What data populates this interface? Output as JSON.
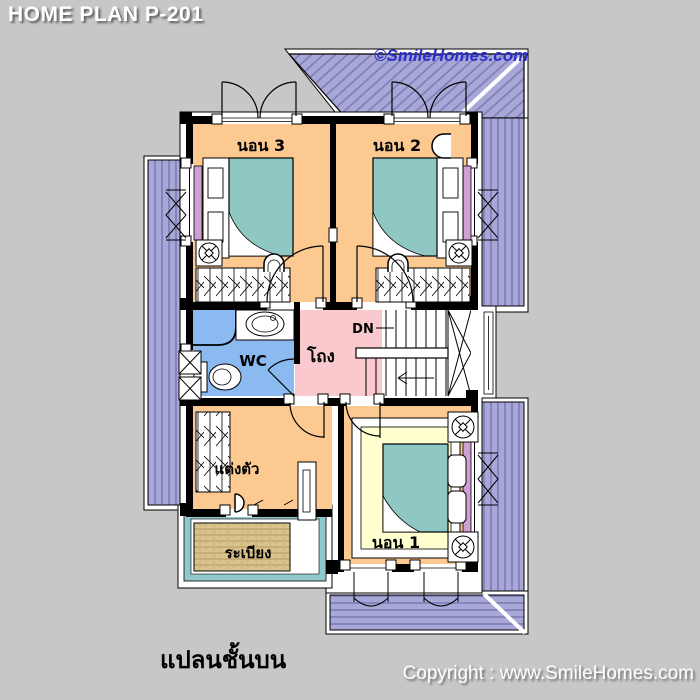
{
  "header": {
    "title": "HOME PLAN P-201"
  },
  "watermark": {
    "text": "©SmileHomes.com"
  },
  "plan": {
    "rooms": [
      {
        "id": "bedroom-3",
        "label": "นอน 3"
      },
      {
        "id": "bedroom-2",
        "label": "นอน 2"
      },
      {
        "id": "wc",
        "label": "WC"
      },
      {
        "id": "hall",
        "label": "โถง"
      },
      {
        "id": "dressing-room",
        "label": "แต่งตัว"
      },
      {
        "id": "balcony",
        "label": "ระเบียง"
      },
      {
        "id": "bedroom-1",
        "label": "นอน 1"
      }
    ],
    "stairs": {
      "down_label": "DN"
    },
    "colors": {
      "background": "#c7c7c7",
      "roof": "#a8a8d8",
      "roof_line": "#7c7cb4",
      "bedroom_floor": "#fcc991",
      "bed": "#8fc7c3",
      "hall_floor": "#f9c9cd",
      "wc_floor": "#8abaf0",
      "window_sill": "#cfa0d4",
      "rug": "#ffffd0",
      "balcony_deck": "#d9c38c",
      "balcony_rail": "#8fc9c9",
      "watermark_blue": "#2e2ecc"
    }
  },
  "caption": {
    "text": "แปลนชั้นบน"
  },
  "footer": {
    "copyright": "Copyright : www.SmileHomes.com"
  }
}
